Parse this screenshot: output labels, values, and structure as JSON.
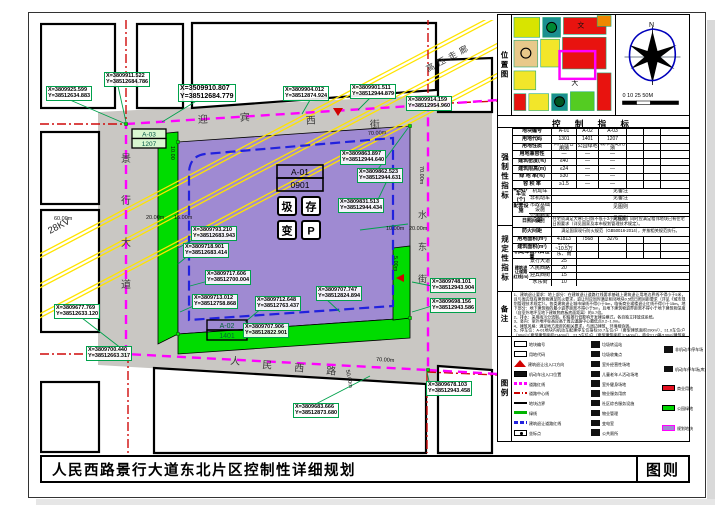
{
  "title": {
    "main": "人民西路景行大道东北片区控制性详细规划",
    "sheet": "图则"
  },
  "map": {
    "roads": {
      "top": "迎宾西街",
      "left": "景行大道",
      "bottom": "人民西路",
      "right": "水东街"
    },
    "hv": {
      "kv": "28KV",
      "label": "高压走廊"
    },
    "blocks": {
      "a01": {
        "code": "A-01",
        "land": "0901"
      },
      "a02": {
        "code": "A-02",
        "land": "1401"
      },
      "a03": {
        "code": "A-03",
        "land": "1207"
      }
    },
    "facility_icons": [
      "圾",
      "存",
      "变",
      "P"
    ],
    "dims": [
      "70.00m",
      "70.00m",
      "70.00m",
      "60.00m",
      "20.00m",
      "15.00m",
      "10.00",
      "10.00m",
      "20.00m",
      "5.00m",
      "50.00m"
    ],
    "coordinates": [
      {
        "x": "X=3809925.599",
        "y": "Y=38512634.883"
      },
      {
        "x": "X=3809911.522",
        "y": "Y=38512684.786"
      },
      {
        "x": "X=3509910.807",
        "y": "Y=38512684.779"
      },
      {
        "x": "X=3809904.012",
        "y": "Y=38512874.924"
      },
      {
        "x": "X=3809901.511",
        "y": "Y=38512944.879"
      },
      {
        "x": "X=3809914.159",
        "y": "Y=38512954.960"
      },
      {
        "x": "X=3809863.897",
        "y": "Y=38512944.640"
      },
      {
        "x": "X=3809862.523",
        "y": "Y=38512944.631"
      },
      {
        "x": "X=3809831.513",
        "y": "Y=38512944.434"
      },
      {
        "x": "X=3809793.210",
        "y": "Y=38512683.943"
      },
      {
        "x": "X=3809718.901",
        "y": "Y=38512683.414"
      },
      {
        "x": "X=3809717.606",
        "y": "Y=38512700.004"
      },
      {
        "x": "X=3809713.012",
        "y": "Y=38512758.868"
      },
      {
        "x": "X=3809712.648",
        "y": "Y=38512763.437"
      },
      {
        "x": "X=3809707.747",
        "y": "Y=38512824.894"
      },
      {
        "x": "X=3809707.906",
        "y": "Y=38512822.901"
      },
      {
        "x": "X=3809677.769",
        "y": "Y=38512633.120"
      },
      {
        "x": "X=3809700.440",
        "y": "Y=38512663.317"
      },
      {
        "x": "X=3809683.666",
        "y": "Y=38512873.680"
      },
      {
        "x": "X=3809748.101",
        "y": "Y=38512943.904"
      },
      {
        "x": "X=3809698.156",
        "y": "Y=38512943.586"
      },
      {
        "x": "X=3809678.103",
        "y": "Y=38512943.458"
      }
    ]
  },
  "panel": {
    "location_label": "位置图",
    "compass_n": "N",
    "scale_ticks": "0  10  25      50M",
    "table_title": "控 制 指 标",
    "side_labels": {
      "mandatory": "强制性指标",
      "prescriptive": "规定性指标",
      "notes": "备注",
      "legend": "图例"
    },
    "table": {
      "rows": [
        {
          "kind": "simple",
          "label": "地块编号",
          "cells": [
            "A-01",
            "A-02",
            "A-03"
          ]
        },
        {
          "kind": "simple",
          "label": "用地代码",
          "cells": [
            "1301",
            "1401",
            "1207"
          ]
        },
        {
          "kind": "simple",
          "label": "用地性质",
          "cells": [
            "商住混合用地",
            "公园绿地",
            "城市道路用地"
          ]
        },
        {
          "kind": "simple",
          "label": "用地兼容性",
          "cells": [
            "—",
            "—",
            "—"
          ]
        },
        {
          "kind": "simple",
          "label": "建筑密度(%)",
          "cells": [
            "≤40",
            "—",
            "—"
          ]
        },
        {
          "kind": "simple",
          "label": "建筑限高(m)",
          "cells": [
            "≤24",
            "—",
            "—"
          ]
        },
        {
          "kind": "simple",
          "label": "绿 地 率(%)",
          "cells": [
            "≥30",
            "—",
            "—"
          ]
        },
        {
          "kind": "simple",
          "label": "容 积 率",
          "cells": [
            "≥1.5",
            "—",
            "—"
          ]
        },
        {
          "kind": "sub2",
          "label": "配建停车位(个)",
          "subs": [
            {
              "label": "机动车",
              "value": "见备注"
            },
            {
              "label": "非机动车",
              "value": "见备注"
            }
          ]
        },
        {
          "kind": "sub2",
          "label": "配套设施",
          "subs": [
            {
              "label": "市政基础设施",
              "value": "见图则"
            },
            {
              "label": "公用服务设施",
              "value": "见图则"
            }
          ]
        },
        {
          "kind": "span",
          "label": "日照间距",
          "value": "住宅须满足大寒日日照不低于2小时标准，同时应满足相邻地块已有住宅日照要求（详见国家及本市规划管理技术规定）。"
        },
        {
          "kind": "span",
          "label": "防火间距",
          "value": "满足国家现行防火规范（GB50016-2014），并按相关规范执行。"
        },
        {
          "kind": "simple",
          "label": "用地面积(m²)",
          "cells": [
            "41813",
            "7568",
            "3276"
          ]
        },
        {
          "kind": "simple",
          "label": "建筑面积(m²)",
          "cells": [
            "8.4万~10.5万",
            "",
            ""
          ]
        },
        {
          "kind": "simple",
          "label": "机动车出入口位置",
          "cells": [
            "东、南",
            "",
            ""
          ]
        },
        {
          "kind": "setback",
          "label": "建筑退让道路红线(m)",
          "subs": [
            {
              "label": "景行大道",
              "value": "25"
            },
            {
              "label": "人民西路",
              "value": "20"
            },
            {
              "label": "迎宾西街",
              "value": "15"
            },
            {
              "label": "水东街",
              "value": "10"
            }
          ]
        }
      ]
    },
    "notes_lines": [
      "1、建筑退让要求：地上部分：在建筑退让道路红线要求基础上建筑退让用地边界线不得小于5米，且与周边现有建筑物满足防火要求，退让时应同时满足相邻地块0.5倍日照间距要求（详见《城市规划管理技术规定》）。各类建筑退让城市绿线不得小于5m，临街商业裙楼退让红线不得小于15m。地下部分：地下建筑物的最小退界距离不得小于5m，且地下建筑物退界距离不得小于地下建筑物深度（自室外地坪至地下建筑物底板底面距离）的0.7倍。",
      "2、排水：采用雨污分流制，积极推行低影响开发建设模式，各自独立排放成系统。",
      "3、竖向：室外地坪标高应高于周边道路中心最低点0.2~1.0m。",
      "4、建筑风格：满足地方政府的相关要求，与周边建筑、环境相协调。",
      "5、停车位：A-01地块内机动车配建停车位指标≥0.7车位/户（套型建筑面积≤90m²）、≥1.0车位/户（90m²＜套型建筑面积≤140m²）、≥1.5车位/户（套型建筑面积＞140m²），商业≥1.0辆/100m²建筑面积。配建停车位应100%建设充电设施或预留建设安装条件，其中不少于10%的车位应与住宅项目同步建成充电设施，应预留同步使用要求，地上停车位数不得超过总停车位数的10%。非机动车停车位：住宅≥2.0辆/户，商业≥4.0辆/100m²建筑面积。"
    ],
    "legend": {
      "col1": [
        {
          "sym": "s-code",
          "label": "地块编号"
        },
        {
          "sym": "s-code",
          "label": "用地代码"
        },
        {
          "sym": "s-tri",
          "label": "建筑退让出入口方向"
        },
        {
          "sym": "s-gate",
          "label": "机动车出入口位置"
        },
        {
          "sym": "s-lineM",
          "label": "道路红线"
        },
        {
          "sym": "s-lineR",
          "label": "道路中心线"
        },
        {
          "sym": "s-lineK",
          "label": "地块边界"
        },
        {
          "sym": "s-lineG",
          "label": "绿线"
        },
        {
          "sym": "s-lineB",
          "label": "建筑退让道路红线"
        },
        {
          "sym": "s-pt",
          "label": "坐标点"
        }
      ],
      "col2": [
        {
          "sym": "s-sq",
          "label": "垃圾转运站"
        },
        {
          "sym": "s-sq",
          "label": "垃圾收集点"
        },
        {
          "sym": "s-sq",
          "label": "室外经营性场地"
        },
        {
          "sym": "s-sq",
          "label": "儿童老年人活动场地"
        },
        {
          "sym": "s-sq",
          "label": "室外健身场地"
        },
        {
          "sym": "s-sq",
          "label": "物业服务用房"
        },
        {
          "sym": "s-sq",
          "label": "社区综合服务设施"
        },
        {
          "sym": "s-sq",
          "label": "物业管理"
        },
        {
          "sym": "s-sq",
          "label": "变电室"
        },
        {
          "sym": "s-sq",
          "label": "公共厕所"
        }
      ],
      "col3": [
        {
          "sym": "s-sq",
          "label": "非机动车停车场"
        },
        {
          "sym": "s-sq",
          "label": "机动车停车场(库)"
        },
        {
          "sym": "s-fillR",
          "label": "商业用地"
        },
        {
          "sym": "s-fillG",
          "label": "公园绿地"
        },
        {
          "sym": "s-fillP",
          "label": "规划地块"
        }
      ]
    }
  }
}
